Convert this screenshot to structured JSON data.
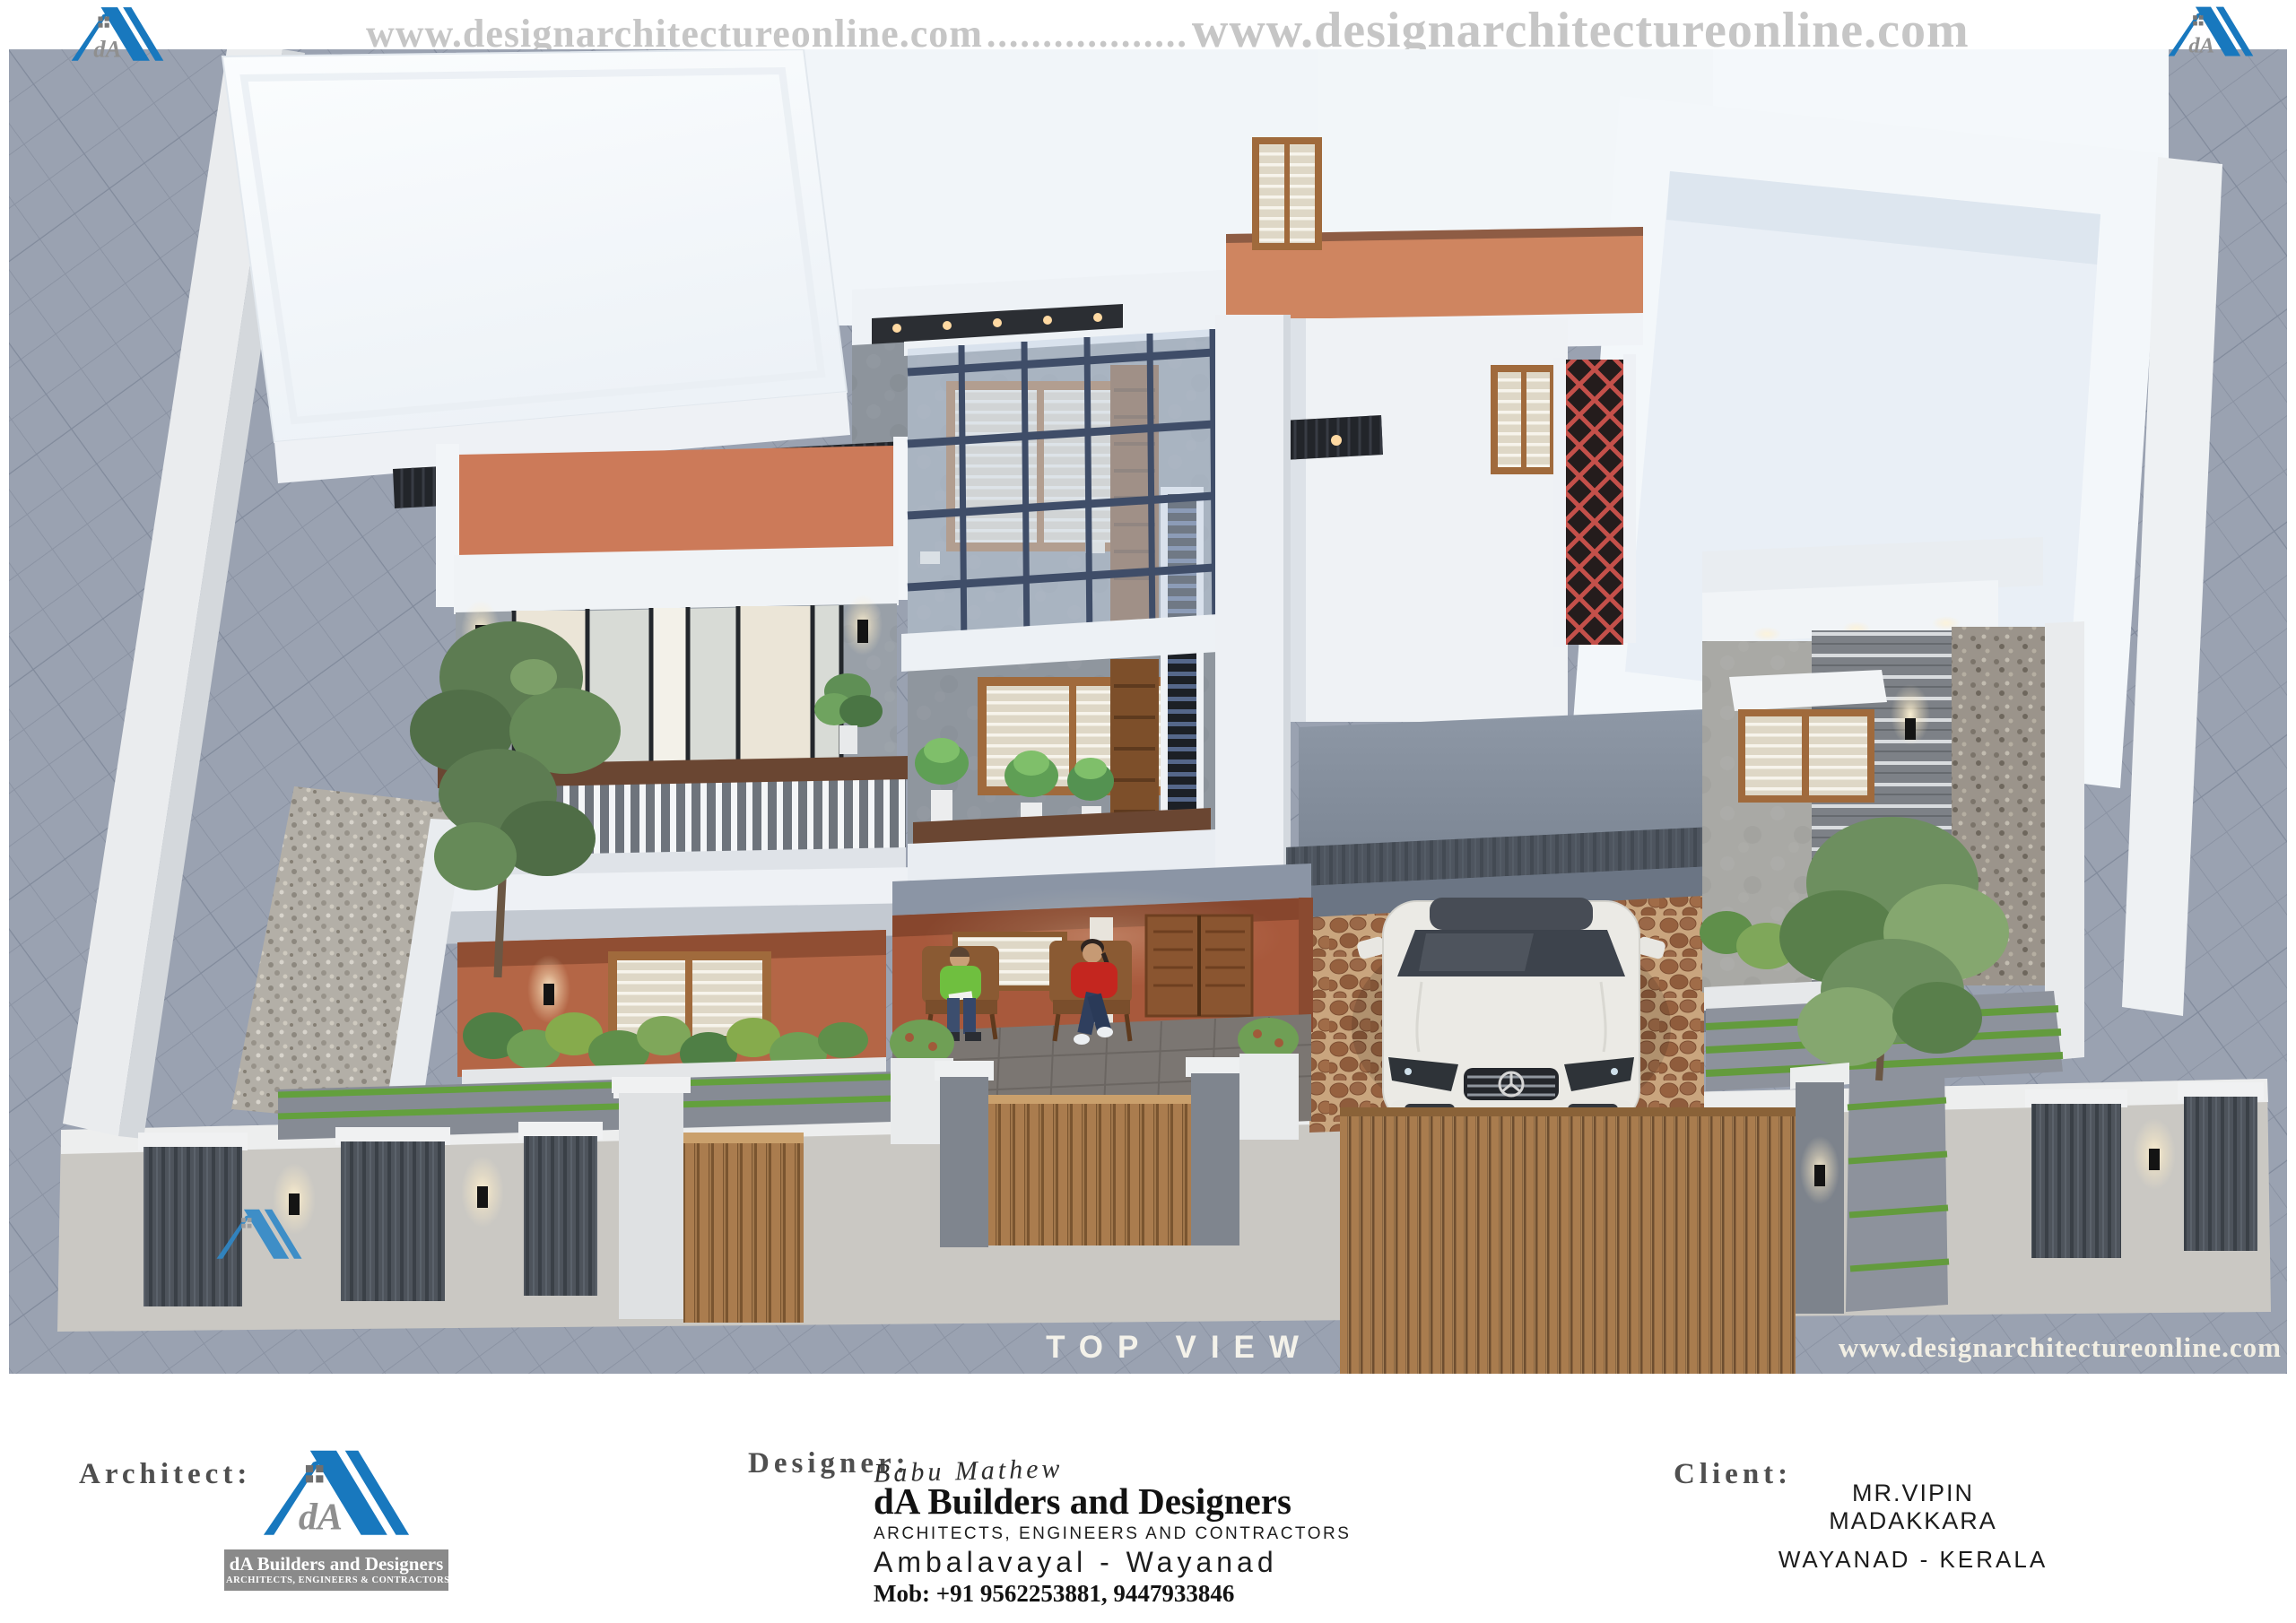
{
  "colors": {
    "brand_blue": "#1878be",
    "banner_text": "#c6c6c6",
    "label_gray": "#4f4f4f",
    "label_white": "#f4f2ea",
    "logo_banner_bg": "#8a8a8a",
    "logo_text_gray": "#8a8a8a",
    "paving_gray": "#9aa2b1",
    "roof_white": "#f4f8fb",
    "terracotta": "#cc7a59",
    "porch_wall": "#a8593c",
    "jali_red": "#c4504a",
    "wood_brown": "#a06a3c",
    "gate_brown": "#a97c4e",
    "panel_dark": "#4e545c",
    "compound_wall": "#cac8c3",
    "foliage_green": "#5d7c52",
    "glass_frame": "#3f4d68"
  },
  "header": {
    "url": "www.designarchitectureonline.com",
    "dots": ".................."
  },
  "logo": {
    "monogram": "dA",
    "name": "dA Builders and Designers",
    "tagline": "ARCHITECTS, ENGINEERS & CONTRACTORS"
  },
  "render": {
    "view_label": "TOP VIEW",
    "watermark": "www.designarchitectureonline.com"
  },
  "titleblock": {
    "architect": {
      "label": "Architect:"
    },
    "designer": {
      "label": "Designer:",
      "signature": "Babu Mathew",
      "firm": "dA Builders and Designers",
      "firm_subtitle": "ARCHITECTS, ENGINEERS AND CONTRACTORS",
      "location": "Ambalavayal - Wayanad",
      "mobile": "Mob: +91 9562253881, 9447933846"
    },
    "client": {
      "label": "Client:",
      "name": "MR.VIPIN MADAKKARA",
      "location": "WAYANAD - KERALA"
    }
  }
}
